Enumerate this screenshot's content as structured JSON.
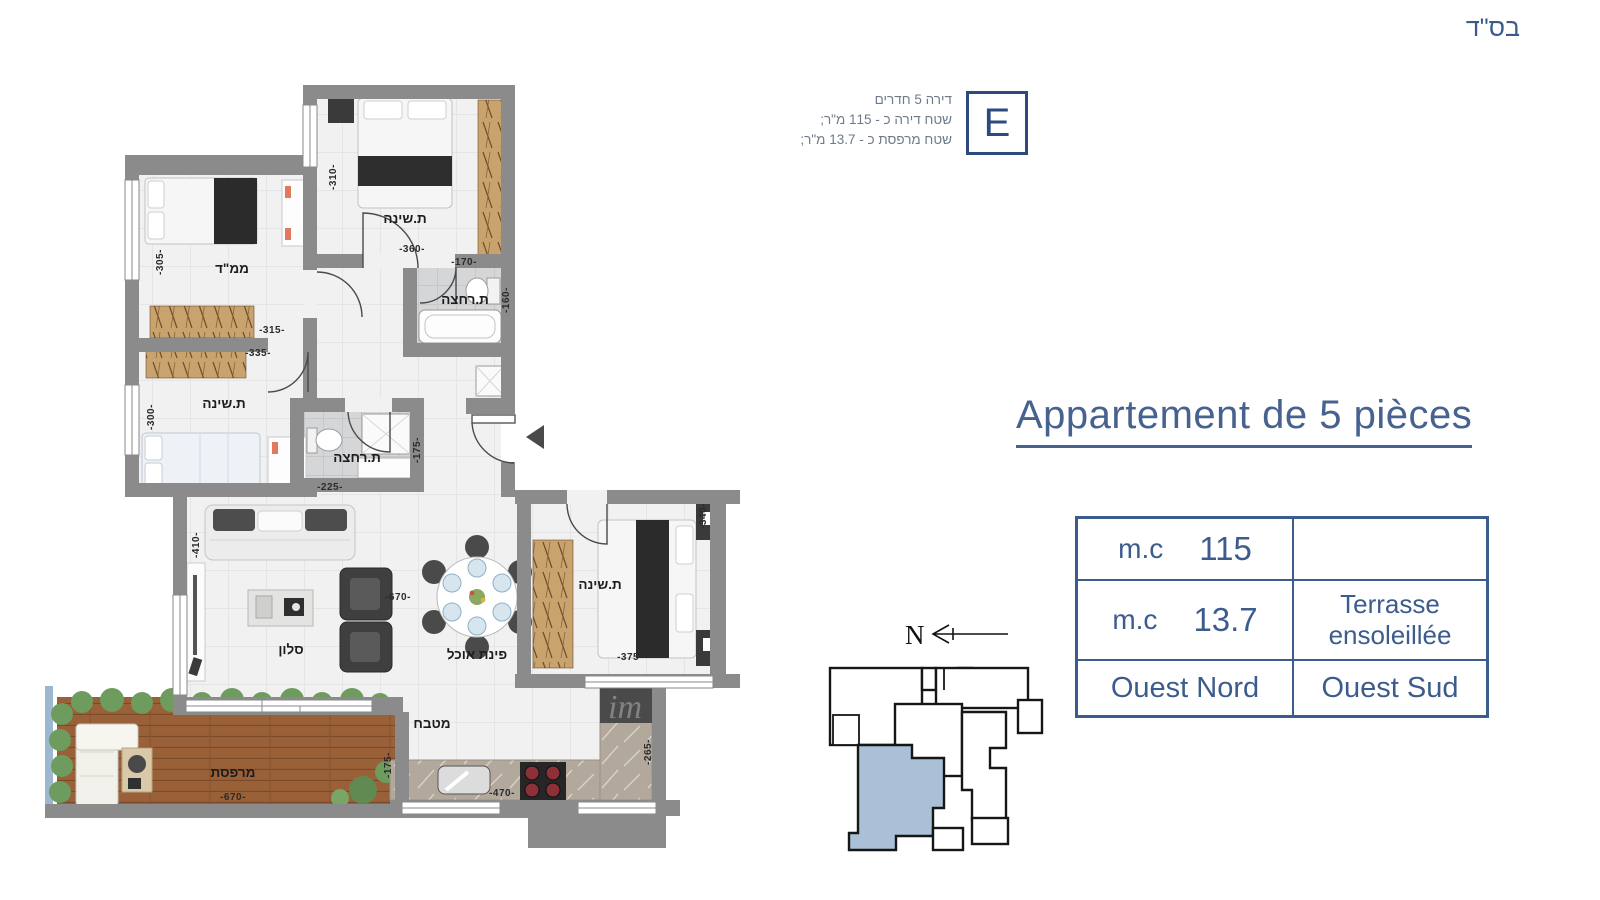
{
  "header": {
    "bsd": "בס\"ד"
  },
  "unit_card": {
    "letter": "E",
    "info_lines": [
      "דירה 5 חדרים",
      "שטח דירה כ - 115 מ\"ר;",
      "שטח מרפסת כ - 13.7 מ\"ר;"
    ]
  },
  "title": "Appartement de 5 pièces",
  "spec_table": {
    "r1_unit": "m.c",
    "r1_value": "115",
    "r1_note": "",
    "r2_unit": "m.c",
    "r2_value": "13.7",
    "r2_note1": "Terrasse",
    "r2_note2": "ensoleillée",
    "r3_left": "Ouest Nord",
    "r3_right": "Ouest Sud"
  },
  "compass": {
    "north_label": "N"
  },
  "watermark": "im",
  "plan": {
    "rooms": {
      "bedroom_top": "ת.שינה",
      "bath_top": "ת.רחצה",
      "mamad": "ממ\"ד",
      "bedroom_left": "ת.שינה",
      "bath_mid": "ת.רחצה",
      "salon": "סלון",
      "dining": "פינת אוכל",
      "bedroom_right": "ת.שינה",
      "kitchen": "מטבח",
      "terrace": "מרפסת"
    },
    "dims": {
      "d310": "-310-",
      "d360": "-360-",
      "d170": "-170-",
      "d160": "-160-",
      "d305": "-305-",
      "d315": "-315-",
      "d335": "-335-",
      "d300": "-300-",
      "d225": "-225-",
      "d175a": "-175-",
      "d410": "-410-",
      "d670a": "-670-",
      "d340": "-340-",
      "d375": "-375-",
      "d470": "-470-",
      "d265": "-265-",
      "d670b": "-670-",
      "d175b": "-175-"
    }
  },
  "colors": {
    "accent": "#3d5c8e",
    "wall": "#8b8b8b",
    "locator_highlight": "#a9c0d6"
  }
}
